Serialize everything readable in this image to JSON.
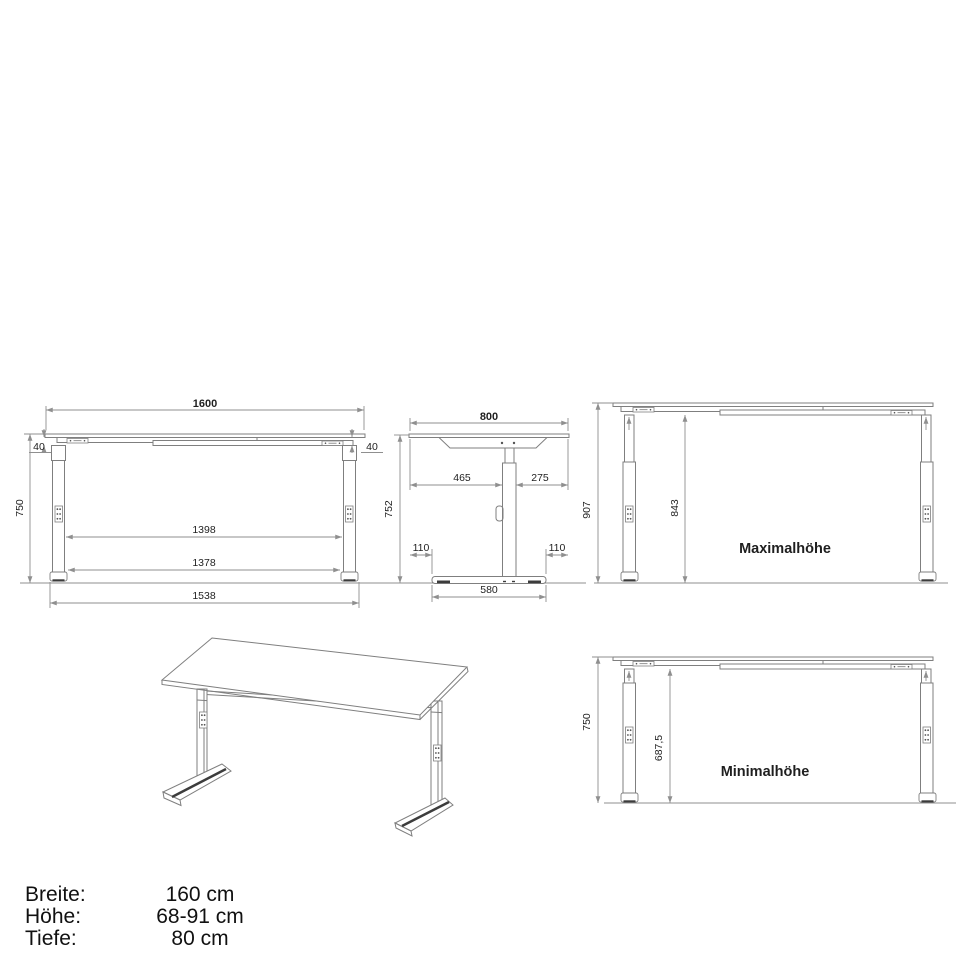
{
  "front_view": {
    "width_top": "1600",
    "overhang_left": "40",
    "overhang_right": "40",
    "height": "750",
    "legs_inner": "1398",
    "feet_inner": "1378",
    "feet_outer": "1538"
  },
  "side_view": {
    "depth": "800",
    "offset_left": "465",
    "offset_right": "275",
    "height": "752",
    "foot_margin_left": "110",
    "foot_margin_right": "110",
    "foot_length": "580"
  },
  "max_view": {
    "label": "Maximalhöhe",
    "height_total": "907",
    "height_clear": "843"
  },
  "min_view": {
    "label": "Minimalhöhe",
    "height_total": "750",
    "height_clear": "687,5"
  },
  "specs": {
    "rows": [
      {
        "label": "Breite:",
        "value": "160 cm"
      },
      {
        "label": "Höhe:",
        "value": "68-91 cm"
      },
      {
        "label": "Tiefe:",
        "value": "80 cm"
      }
    ]
  },
  "colors": {
    "object_line": "#7f7f7f",
    "dimension_line": "#8f8f8f",
    "text": "#1f1f1f"
  }
}
